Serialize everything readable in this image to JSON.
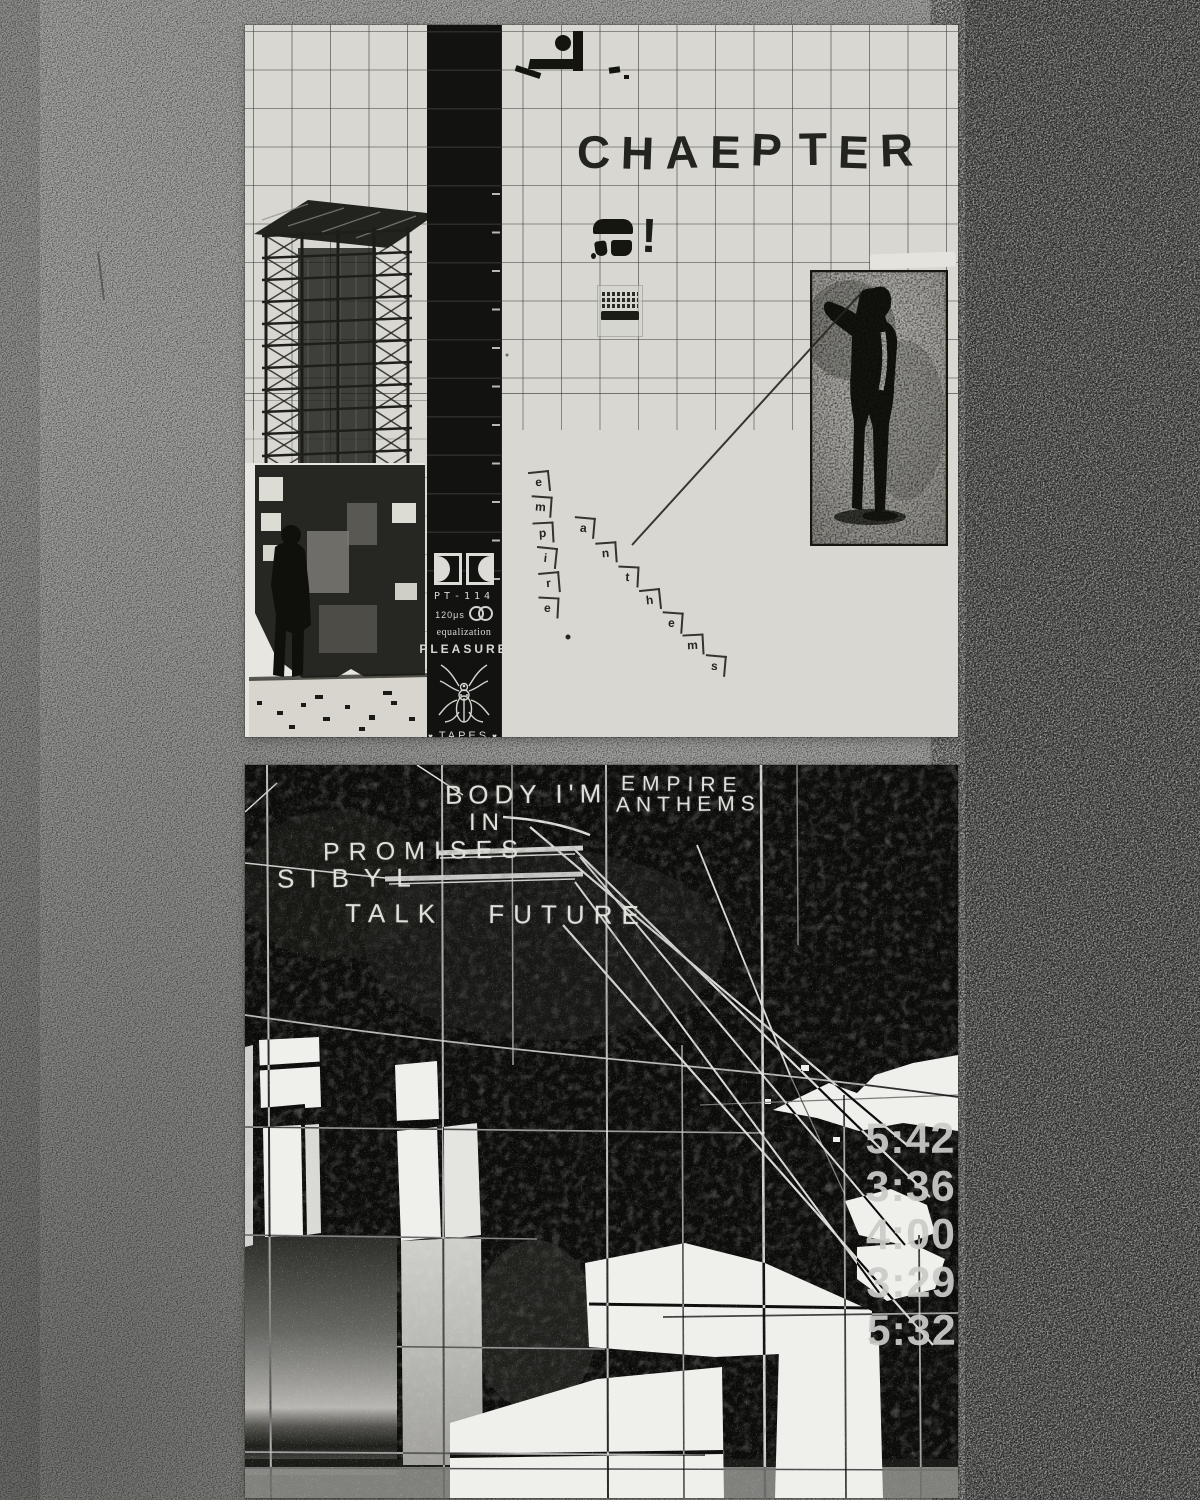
{
  "front_cover": {
    "title_letters": [
      "C",
      "H",
      "A",
      "E",
      "P",
      "T",
      "E",
      "R"
    ],
    "exclamation": "!",
    "vertical_word_letters": [
      "e",
      "m",
      "p",
      "i",
      "r",
      "e"
    ],
    "diagonal_word_letters": [
      "a",
      "n",
      "t",
      "h",
      "e",
      "m",
      "s"
    ],
    "spine": {
      "catalog_number": "PT-114",
      "eq_time_constant": "120μs",
      "eq_label": "equalization",
      "label_name": "PLEASURE",
      "label_suffix": "TAPES",
      "heart": "♥"
    }
  },
  "back_cover": {
    "tracks": [
      {
        "display": [
          "BODY I'M",
          "IN"
        ],
        "duration": "5:42"
      },
      {
        "display": [
          "EMPIRE",
          "ANTHEMS"
        ],
        "duration": "3:36"
      },
      {
        "display": [
          "PROMISES"
        ],
        "duration": "4:00"
      },
      {
        "display": [
          "SIBYL"
        ],
        "duration": "3:29"
      },
      {
        "display": [
          "TALK FUTURE"
        ],
        "duration": "5:32"
      }
    ]
  },
  "colors": {
    "paper": "#d8d7d2",
    "ink": "#232320",
    "spine_black": "#121210",
    "panel_black": "#0a0a0a",
    "back_text": "#e0e0db",
    "duration_text": "#cbcbc8",
    "background_gray": "#a2a29f",
    "background_dark_band": "#727270"
  }
}
